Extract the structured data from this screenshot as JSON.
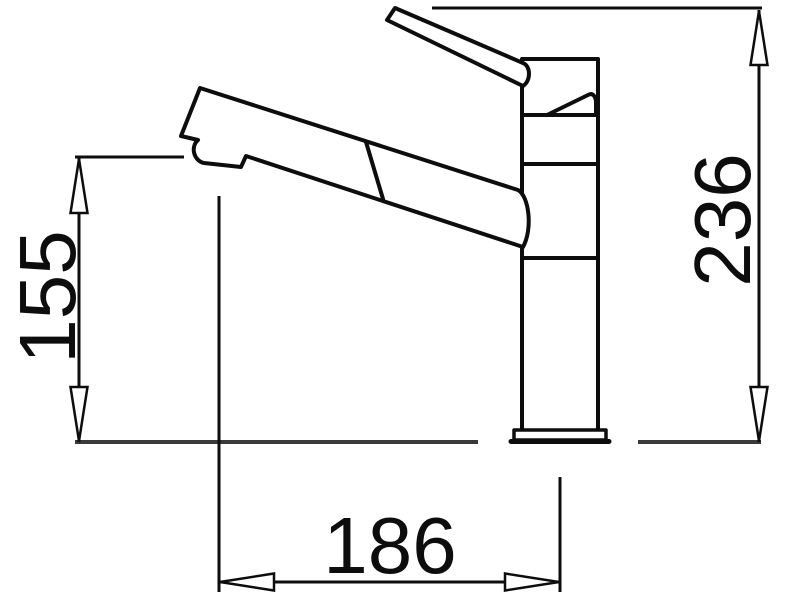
{
  "figure": {
    "description": "Technical line drawing of a single-lever kitchen mixer tap, side view, with dimension lines"
  },
  "dimensions": {
    "spout_height": "155",
    "overall_height": "236",
    "spout_reach": "186"
  },
  "colors": {
    "line": "#0d0d0d",
    "reference_line": "#3a3a3a",
    "text": "#0d0d0d",
    "background": "#ffffff"
  }
}
